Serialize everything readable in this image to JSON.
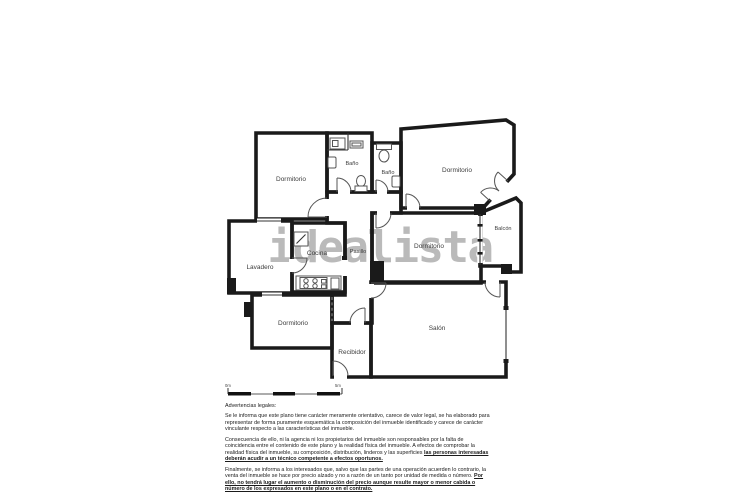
{
  "watermark": "idealista",
  "plan": {
    "rooms": {
      "dormitorio_tl": "Dormitorio",
      "bano_1": "Baño",
      "bano_2": "Baño",
      "dormitorio_tr": "Dormitorio",
      "balcon": "Balcón",
      "dormitorio_mid": "Dormitorio",
      "pasillo": "Pasillo",
      "cocina": "Cocina",
      "lavadero": "Lavadero",
      "dormitorio_bl": "Dormitorio",
      "recibidor": "Recibidor",
      "salon": "Salón"
    },
    "scale_bar": {
      "start": "0m",
      "end": "5m"
    }
  },
  "legal": {
    "title": "Advertencias legales:",
    "p1": "Se le informa que este plano tiene carácter meramente orientativo, carece de valor legal, se ha elaborado para representar de forma puramente esquemática la composición del inmueble identificado y carece de carácter vinculante respecto a las características del inmueble.",
    "p2": "Consecuencia de ello, ni la agencia ni los propietarios del inmueble son responsables por la falta de coincidencia entre el contenido de este plano y la realidad física del inmueble. A efectos de comprobar la realidad física del inmueble, su composición, distribución, linderos y las superficies",
    "p2_emphasis": "las personas interesadas deberán acudir a un técnico competente a efectos oportunos.",
    "p3": "Finalmente, se informa a los interesados que, salvo que las partes de una operación acuerden lo contrario, la venta del inmueble se hace por precio alzado y no a razón de un tanto por unidad de medida o número.",
    "p3_emphasis": "Por ello, no tendrá lugar el aumento o disminución del precio aunque resulte mayor o menor cabida o número de los expresados en este plano o en el contrato."
  },
  "colors": {
    "wall": "#1a1a1a",
    "watermark": "#a9a9a9",
    "label": "#3c3c3c"
  }
}
